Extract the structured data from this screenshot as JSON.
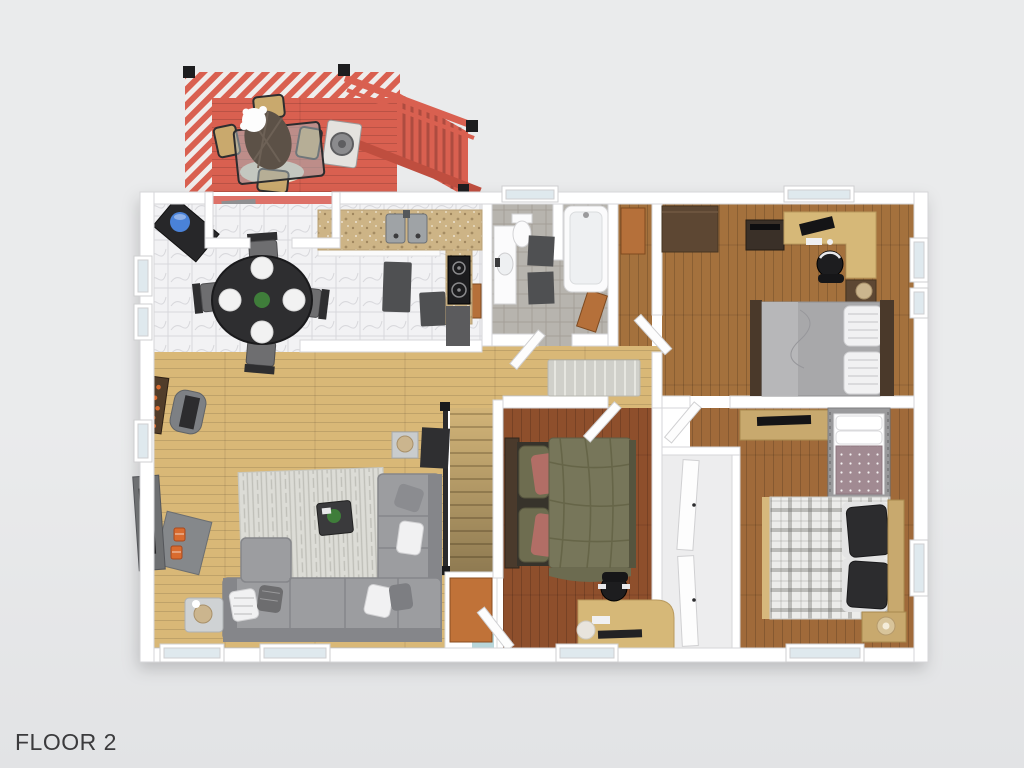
{
  "page": {
    "floor_label": "FLOOR 2"
  },
  "colors": {
    "background": "#eaebec",
    "background_dim": "#e2e3e5",
    "text": "#3b3b3d",
    "wall": "#ffffff",
    "wall_edge": "#d6d6d8",
    "deck_red": "#d96050",
    "deck_red_dark": "#bf4e3f",
    "rail_white": "#efedec",
    "porch_pink": "#dd7168",
    "marble": "#f2f2f4",
    "marble_line": "#d8d8dc",
    "bath_tile": "#b7b4ae",
    "bath_tile_line": "#a49f98",
    "wood_living": "#d9b877",
    "wood_bed1": "#a4713d",
    "wood_bed2": "#8e4f2c",
    "wood_bed3": "#a06a3a",
    "granite": "#cdb486",
    "counter_dark": "#5b5b5d",
    "appliance": "#1c1c1e",
    "steel": "#9fa3a6",
    "sofa": "#9c9da0",
    "sofa_dark": "#85868a",
    "rug": "#dcdcd6",
    "table_dark": "#2e2e30",
    "seat_gray": "#6e6e70",
    "plate": "#f2f2f2",
    "plant": "#3f7d3a",
    "fire_orange": "#d96b2f",
    "fireplace": "#6e7072",
    "lamp": "#cbb58e",
    "desk_tan": "#d6b878",
    "furn_tan": "#c8a96e",
    "furn_brown": "#5d4733",
    "furn_dark": "#3a3028",
    "bed_olive": "#77765a",
    "pillow_olive": "#6e6d50",
    "pillow_rose": "#b26e66",
    "bed_gray": "#a8a8aa",
    "pillow_white": "#f1f1f2",
    "plaid_white": "#ececea",
    "pillow_black": "#2c2c2e",
    "crib_gray": "#9a9a9c",
    "crib_mauve": "#a18a92",
    "stair_wood": "#d2b478",
    "railing_dark": "#2a2a2c",
    "mat_dark": "#4f5052",
    "door_orange": "#c07238",
    "door_brown": "#b5703a",
    "window_glass": "#dfe9ee",
    "jug_blue": "#4a82d8",
    "aqua": "#b8d6da",
    "runner": "#d0d0ca",
    "closet_floor": "#ededee"
  }
}
